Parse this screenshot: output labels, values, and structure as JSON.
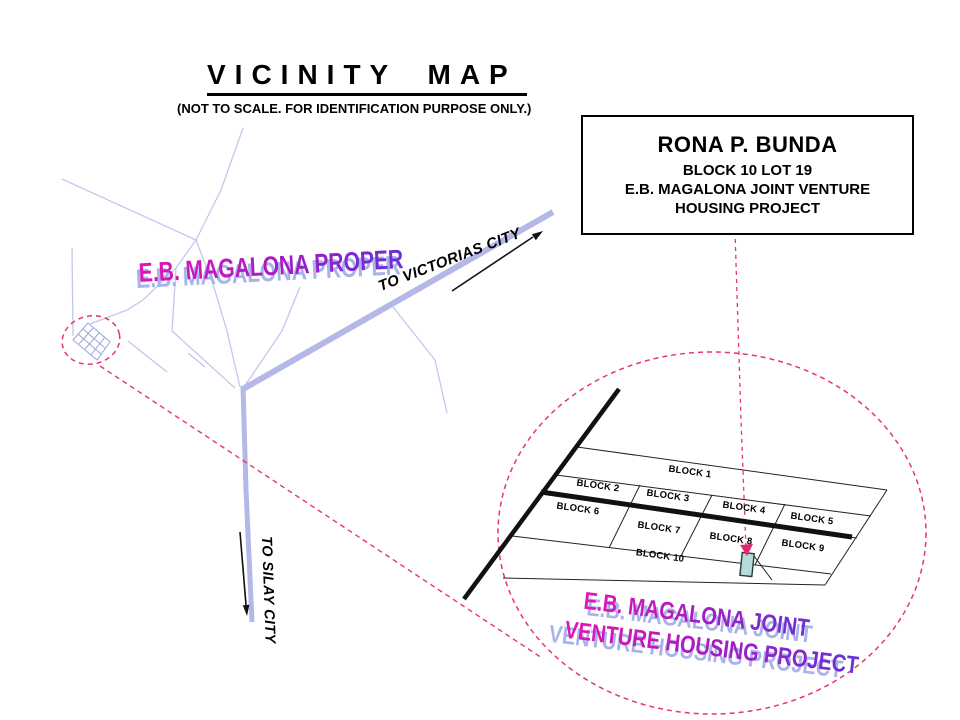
{
  "title": "VICINITY MAP",
  "subtitle": "(NOT TO SCALE. FOR IDENTIFICATION PURPOSE ONLY.)",
  "callout": {
    "name": "RONA P. BUNDA",
    "block_lot": "BLOCK 10 LOT 19",
    "project_line1": "E.B. MAGALONA JOINT VENTURE",
    "project_line2": "HOUSING PROJECT"
  },
  "road_labels": {
    "to_victorias": "TO VICTORIAS CITY",
    "to_silay": "TO SILAY CITY"
  },
  "area_labels": {
    "town_proper": "E.B. MAGALONA PROPER",
    "project_line1": "E.B. MAGALONA JOINT",
    "project_line2": "VENTURE HOUSING PROJECT"
  },
  "blocks": [
    "BLOCK 1",
    "BLOCK 2",
    "BLOCK 3",
    "BLOCK 4",
    "BLOCK 5",
    "BLOCK 6",
    "BLOCK 7",
    "BLOCK 8",
    "BLOCK 9",
    "BLOCK 10"
  ],
  "colors": {
    "road_main": "#b3b8e8",
    "road_minor": "#c3c7ec",
    "highlight_dashed": "#e8356e",
    "lot_fill": "#b7dadb",
    "lot_marker": "#e8246a",
    "wordart_gradient_start": "#e414b6",
    "wordart_gradient_end": "#6633d6",
    "wordart_shadow": "#a9b3ea",
    "subdivision_road": "#111111"
  }
}
